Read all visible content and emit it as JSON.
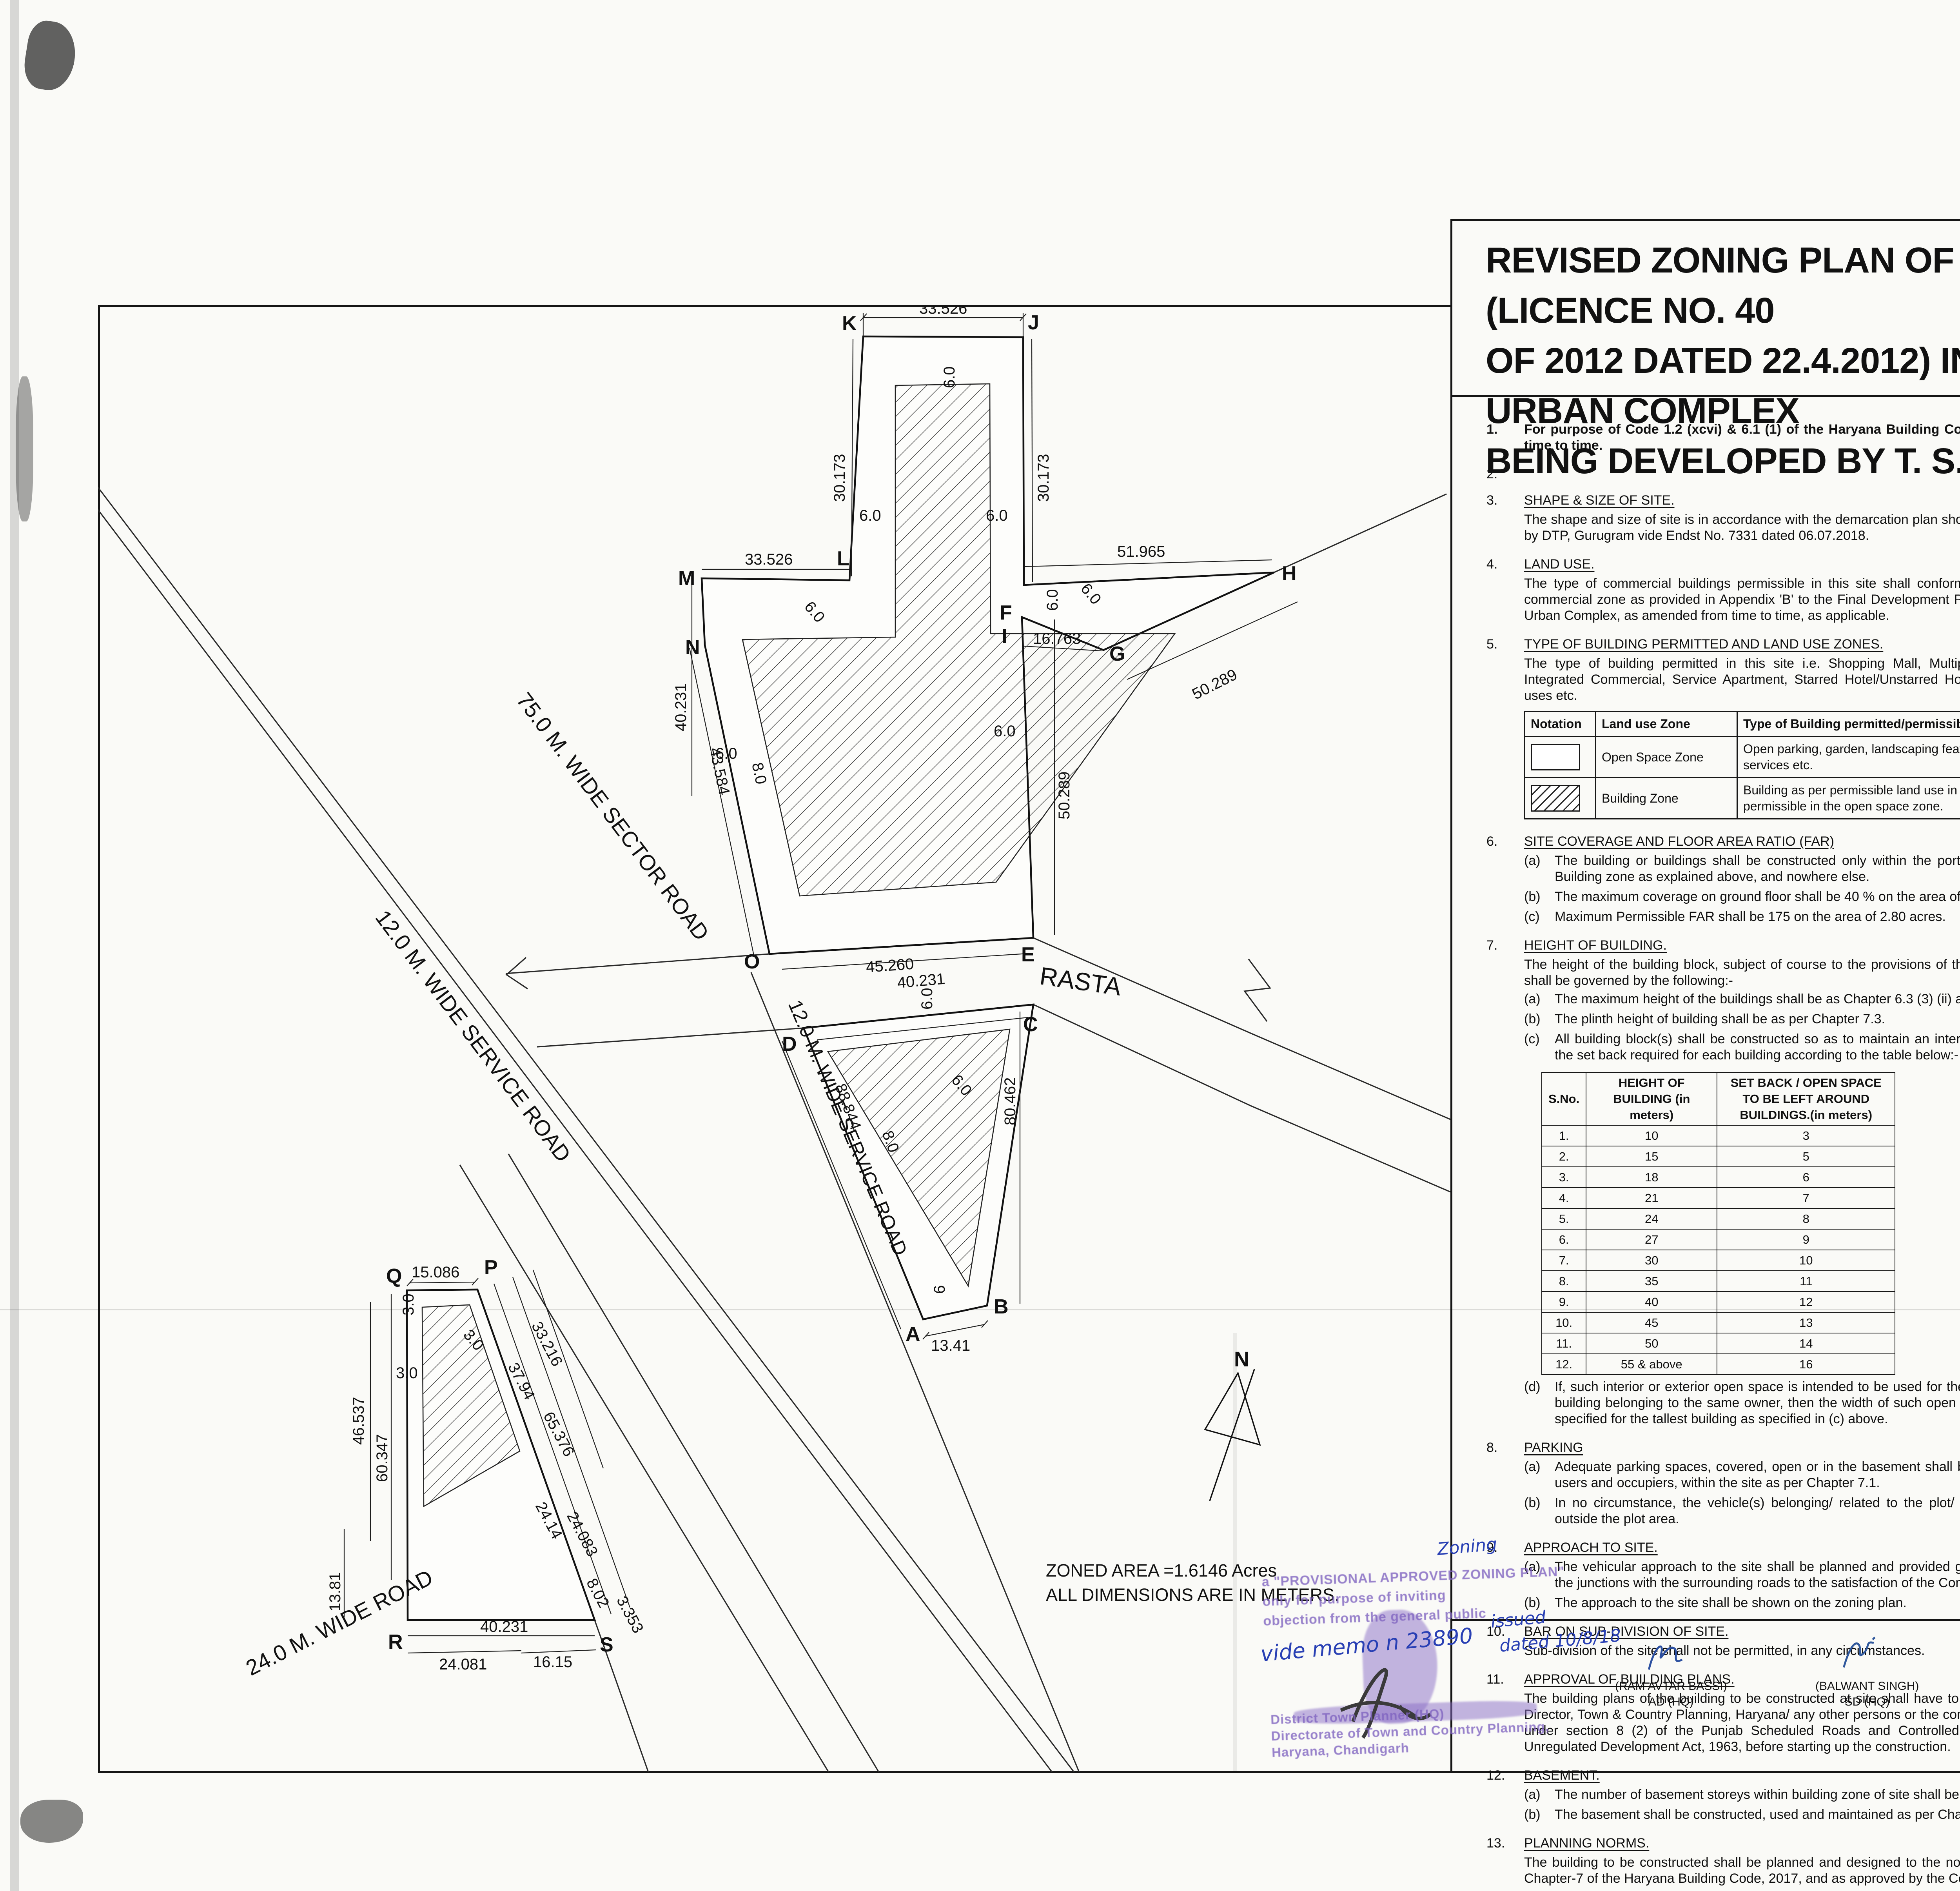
{
  "title": {
    "line1": "REVISED ZONING PLAN OF COMMERCIAL SITE MEASURING 2.80 ACRES (LICENCE NO. 40",
    "line2": "OF 2012 DATED 22.4.2012) IN SECTOR-85 & 86, GURUGRAM MANESAR URBAN COMPLEX",
    "line3": "BEING DEVELOPED BY T. S. REALTECH PVT. LTD."
  },
  "drawing": {
    "vertices": {
      "A": "A",
      "B": "B",
      "C": "C",
      "D": "D",
      "E": "E",
      "F": "F",
      "G": "G",
      "H": "H",
      "I": "I",
      "J": "J",
      "K": "K",
      "L": "L",
      "M": "M",
      "N": "N",
      "O": "O",
      "P": "P",
      "Q": "Q",
      "R": "R",
      "S": "S"
    },
    "dims": {
      "d33526": "33.526",
      "d30173": "30.173",
      "d51965": "51.965",
      "d16763": "16.763",
      "d50289": "50.289",
      "d45260": "45.260",
      "d40231": "40.231",
      "d80462": "80.462",
      "d88844": "88.844",
      "d1341": "13.41",
      "d43584": "43.584",
      "d8": "8.0",
      "d6": "6.0",
      "d6s": "6",
      "d3": "3.0",
      "d15086": "15.086",
      "d46537": "46.537",
      "d60347": "60.347",
      "d1381": "13.81",
      "d33216": "33.216",
      "d3794": "37.94",
      "d65376": "65.376",
      "d2414": "24.14",
      "d24083": "24.083",
      "d802": "8.02",
      "d3353": "3.353",
      "d24081": "24.081",
      "d1615": "16.15"
    },
    "roads": {
      "sector": "75.0 M. WIDE SECTOR ROAD",
      "service_left": "12.0 M. WIDE SERVICE ROAD",
      "service_right": "12.0 M. WIDE SERVICE ROAD",
      "road24": "24.0 M. WIDE ROAD",
      "rasta": "RASTA"
    },
    "north": "N",
    "zoned_line1": "ZONED AREA =1.6146 Acres",
    "zoned_line2": "ALL DIMENSIONS ARE IN METERS."
  },
  "notes_left": {
    "i1": {
      "num": "1.",
      "text": "For purpose of Code 1.2 (xcvi) & 6.1 (1) of the Haryana Building Code, 2017, amended from time to time."
    },
    "i2": {
      "num": "2."
    },
    "i3": {
      "num": "3.",
      "head": "SHAPE & SIZE OF SITE.",
      "p": "The shape and size of site is in accordance with the demarcation plan shown as A to S as confirmed by DTP, Gurugram vide Endst No. 7331 dated 06.07.2018."
    },
    "i4": {
      "num": "4.",
      "head": "LAND USE.",
      "p": "The type of commercial buildings permissible in this site shall conform to the provisions of the commercial zone as provided in Appendix 'B' to the Final Development Plan of Gurugram Manesar Urban Complex, as amended from time to time, as applicable."
    },
    "i5": {
      "num": "5.",
      "head": "TYPE OF BUILDING PERMITTED AND LAND USE ZONES.",
      "p": "The type of building permitted in this site i.e. Shopping Mall, Multiplex, Departmental Store, Integrated Commercial, Service Apartment, Starred Hotel/Unstarred Hotel, Offices & other allied uses etc."
    },
    "i6": {
      "num": "6.",
      "head": "SITE COVERAGE AND FLOOR AREA RATIO (FAR)",
      "a": "(a)",
      "at": "The building or buildings shall be constructed only within the portion of the site marked as Building zone as explained above, and nowhere else.",
      "b": "(b)",
      "bt": "The maximum coverage on ground floor shall be 40 % on the area of 2.80 acres.",
      "c": "(c)",
      "ct": "Maximum Permissible FAR shall be 175  on the area of 2.80 acres."
    },
    "i7": {
      "num": "7.",
      "head": "HEIGHT OF BUILDING.",
      "p": "The height of the building block, subject  of course to the provisions of the site coverage and FAR, shall be governed by the following:-",
      "a": "(a)",
      "at": "The maximum height of the buildings shall be as Chapter 6.3 (3) (ii) and Chapter 6.3 (3) (vii).",
      "b": "(b)",
      "bt": "The plinth height of building shall be as per Chapter 7.3.",
      "c": "(c)",
      "ct": "All building block(s) shall be constructed so as to maintain an inter-se distance not less than the set back required for each building according to the table below:-",
      "d": "(d)",
      "dt": "If, such interior or exterior open space is intended to be used for the benefit of more than one building belonging to the same owner, then the width of such open air space shall be the one specified for the tallest building as specified in (c) above."
    },
    "i8": {
      "num": "8.",
      "head": "PARKING",
      "a": "(a)",
      "at": "Adequate parking spaces, covered, open or in the basement shall be provided for vehicles of users and occupiers, within the site as per Chapter 7.1.",
      "b": "(b)",
      "bt": "In no circumstance, the vehicle(s) belonging/ related to the plot/ premises shall be parked outside the plot area."
    },
    "i9": {
      "num": "9.",
      "head": "APPROACH TO SITE.",
      "a": "(a)",
      "at": "The vehicular approach to the site shall be planned and provided giving due consideration to the junctions with the surrounding roads to the satisfaction of the Competent Authority.",
      "b": "(b)",
      "bt": "The approach to the site shall be shown on the zoning plan."
    },
    "i10": {
      "num": "10.",
      "head": "BAR ON SUB-DIVISION OF SITE.",
      "p": "Sub-division of the site shall not be permitted, in any circumstances."
    },
    "i11": {
      "num": "11.",
      "head": "APPROVAL OF BUILDING PLANS.",
      "p": "The building plans of the building to be constructed at site shall have to be got approved from the Director, Town & Country Planning, Haryana/ any other persons or the committee authorized by him, under section 8 (2) of the Punjab Scheduled Roads and Controlled Areas Restriction of the Unregulated Development Act, 1963, before starting up the construction."
    },
    "i12": {
      "num": "12.",
      "head": "BASEMENT.",
      "a": "(a)",
      "at": "The number of basement storeys within building zone of site shall be as per Chapter 6.3(3)(ii).",
      "b": "(b)",
      "bt": "The basement shall be constructed, used and maintained as per Chapter 7.16."
    },
    "i13": {
      "num": "13.",
      "head": "PLANNING NORMS.",
      "p": "The building to be constructed shall be planned and designed to the norms and standards as per Chapter-7 of the Haryana Building Code, 2017, and as approved by the Competent Authority."
    }
  },
  "land_use_table": {
    "h0": "Notation",
    "h1": "Land use Zone",
    "h2": "Type of Building permitted/permissible structure",
    "r0z": "Open Space Zone",
    "r0t": "Open parking, garden, landscaping features, underground services etc.",
    "r1z": "Building Zone",
    "r1t": "Building as per permissible land use in clause-iii above and uses permissible in the open space zone."
  },
  "height_table": {
    "h0": "S.No.",
    "h1": "HEIGHT OF BUILDING (in meters)",
    "h2": "SET BACK / OPEN SPACE TO BE LEFT AROUND BUILDINGS.(in meters)",
    "rows": [
      [
        "1.",
        "10",
        "3"
      ],
      [
        "2.",
        "15",
        "5"
      ],
      [
        "3.",
        "18",
        "6"
      ],
      [
        "4.",
        "21",
        "7"
      ],
      [
        "5.",
        "24",
        "8"
      ],
      [
        "6.",
        "27",
        "9"
      ],
      [
        "7.",
        "30",
        "10"
      ],
      [
        "8.",
        "35",
        "11"
      ],
      [
        "9.",
        "40",
        "12"
      ],
      [
        "10.",
        "45",
        "13"
      ],
      [
        "11.",
        "50",
        "14"
      ],
      [
        "12.",
        "55 & above",
        "16"
      ]
    ]
  },
  "notes_right": {
    "i13": {
      "num": "13.",
      "head": "PROVISIONS OF PUBLIC HEALTH FACILITIES.",
      "p": "The W.C. and urinals provided in the buildings shall conform to the Haryana Building Code, 2017 and National Building Code, 2016."
    },
    "i14": {
      "num": "14.",
      "head": "EXTERNAL FINISHES",
      "a": "(a)",
      "at": "The external wall finishes, so far as possible shall be in natural or permanent type of materials like bricks, stone, concrete, terracotta, grits, marble, chips, class metals or any other finish which may be allowed by the Competent Authority.",
      "b": "(b)",
      "bt": "All sign boards and names shall be written on the spaces provided on buildings as per approved buildings plans specifically for this purpose and at no other places, whatsoever.",
      "c": "(c)",
      "ct": "For building services, plumbing services, construction practice, building material, foundation and Damp Proof Course Chapter 10 of the Haryana Building Code, 2017 shall be followed."
    },
    "i15": {
      "num": "15.",
      "head": "LIFTS AND RAMPS.",
      "a": "(a)",
      "at": "Lift and Ramps in building shall be provided as per Chapter 7.7 of the Haryana Building Code, 2017.",
      "b": "(b)",
      "bt": "Lift shall be provided with 100% standby generators along with automatic switchover along with staircase of required width and number.",
      "c": "(c)",
      "ct": "Ramps shall also be provided as per the provisions of Haryana Building Code, 2017 and National Building Code, 2016, as applicable."
    },
    "i16": {
      "num": "16.",
      "head": "BUILDING BYE-LAWS",
      "p": "The construction of the building /buildings shall be governed by provisions of the Haryana Building Code, 2017. On the points where Haryana Building Code, 2017 is silent the National Building Code of India, 2016 shall be followed."
    },
    "i17": {
      "num": "17.",
      "head": "FIRE SAFETY MEASURES",
      "a": "(a)",
      "at": "The owner will ensure the provision of proper fire safety measures in the multi storied buildings conforming to the provisions of The Haryana Building Code, 2017/ National Building Code of India, 2016 and the same should be got certified form the Competent Authority.",
      "b": "(b)",
      "bt": "Electric Sub Station/ generator room if provided should be on solid ground near DG/ LT. Control panel on ground floor or in upper basement and it should be located on outer periphery of the building, the same should be got approved form the competent authority.",
      "c": "(c)",
      "ct": "To ensure fire fighting scheme shall be got approved from the Director, Urban Local Bodies, Haryana or any person authorized by the Director, Urban Local Bodies, Haryana. This approval shall be obtained prior to starting the construction work at site."
    },
    "i18": {
      "num": "18.",
      "p": "That the coloniser/owner shall obtain the clearance/NOC as per the provisions of the Notification No. S.O. 1533 (E) Dated 14.9.2006  issued by Ministry of Environment and Forest, Government of India  before starting the construction, if applicable."
    },
    "i19": {
      "num": "19.",
      "p": "That the rain water harvesting system shall be provided as per Central Ground Water Authority norms/Haryana Government notification as applicable."
    },
    "i20": {
      "num": "20.",
      "p": "That the coloniser/owner shall use only Light-Emitting Diode lamps (LED) fitting for internal lighting as well as Campus lighting."
    },
    "i21": {
      "num": "21.",
      "p": "That the coloniser/owner shall strictly comply with the directions issued vide Notification No. 19/6/2016-5P dated 31.03.2016 issued by Haryana Government Renewable Energy Department."
    },
    "i22": {
      "num": "22.",
      "p": "That coloniser/owner shall ensure the installation of Solar Power Plant as per provisions of Haryana Solar Power Policy, 2016 issued by Haryana Government Renewable Energy Department vide Notification No. 19/4/2016-5 Power dated 14.03.2016."
    },
    "i23": {
      "num": "23.",
      "p": "That the coloniser/owner shall ensure the installation of Solar Photovoltaic Power Plant as per the provisions of order No. 22/52/2005-5Power dated 21.03.2016 issued by Haryana Government Renewable Energy Department."
    },
    "i24": {
      "num": "24.",
      "head": "GENERAL",
      "a": "(a)",
      "at": "Among other plans and papers detailed elevations of buildings along all sides exposed to public view shall be drawn according to scale as mentioned in the Haryana Building Code-2017.",
      "b": "(b)",
      "bt": "The water storage tanks and other plumbing works etc. shall not be exposed to view each face of building but shall be suitably encased.",
      "c": "(c)",
      "ct": "No applied decoration like inscription, crosses, names of persons or buildings are permitted on any external face of the building.",
      "d": "(d)",
      "dt": "Garbage collection center of appropriate size shall be provided within the site.",
      "e": "(e)",
      "et": "Color trade emblem and other symbols shall be subject to the approval of the Competent Authority."
    }
  },
  "drg": {
    "label": "DRG No. DTCP-",
    "number": "6570",
    "dated": "Dated",
    "date": "10-08-2018"
  },
  "signatures": [
    {
      "name": "(RAM AVTAR BASSI)",
      "title": "AD (HQ)"
    },
    {
      "name": "(BALWANT SINGH)",
      "title": "SD (HQ)"
    },
    {
      "name": "(SANJAY KUMAR)",
      "title": "DTP (HQ)"
    },
    {
      "name": "(DEVENDRA NIMBOKAR)",
      "title": "STP(M)HQ"
    },
    {
      "name": "(JITENDER SIHAG)",
      "title": "CTP (HR)"
    },
    {
      "name": "(K.MAKRAND PANDURANG, IAS)",
      "title": "DTCP (HR)"
    }
  ],
  "stamp": {
    "line1": "a \"PROVISIONAL APPROVED ZONING PLAN\"",
    "line2": "only for purpose of inviting",
    "line3": "objection from the general public",
    "hand_top": "Zoning",
    "hand_memo": "vide memo n 23890",
    "hand_issued": "issued",
    "hand_dated": "dated 10/8/18",
    "footer1": "District Town Planner (HQ)",
    "footer2": "Directorate of Town and Country Planning,",
    "footer3": "Haryana, Chandigarh"
  }
}
